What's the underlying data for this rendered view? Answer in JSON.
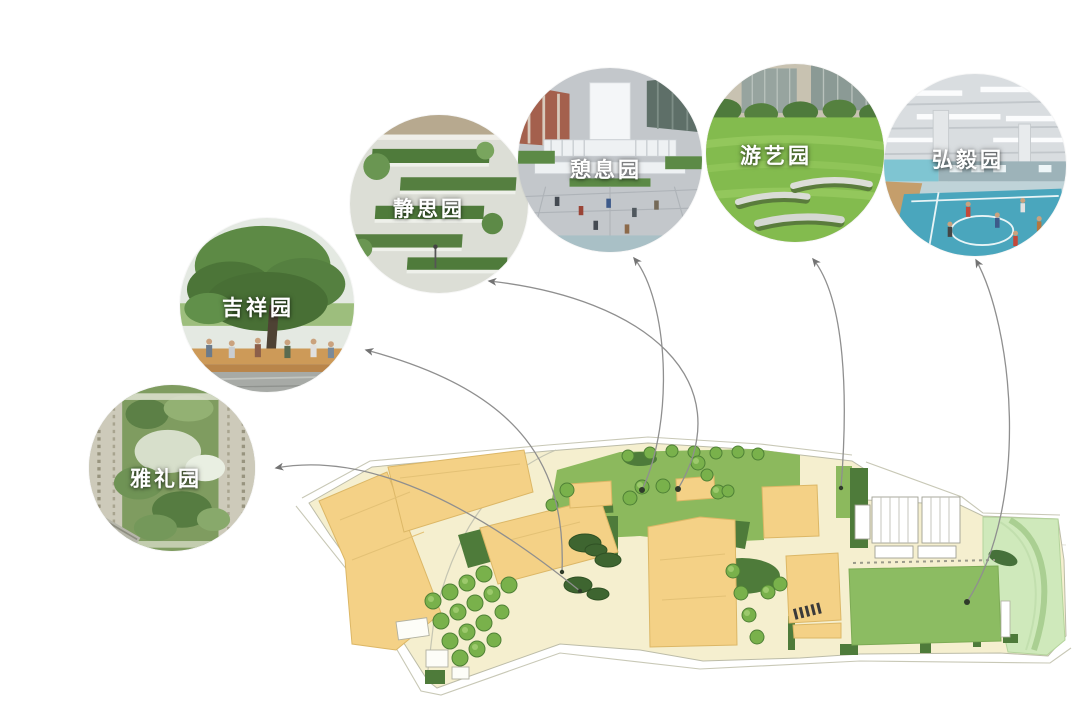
{
  "figure": {
    "type": "campus-landscape-diagram",
    "description_note": "site plan with six circular photo callouts connected by curved arrows"
  },
  "gardens": [
    {
      "id": "yali",
      "label": "雅礼园"
    },
    {
      "id": "jixiang",
      "label": "吉祥园"
    },
    {
      "id": "jingsi",
      "label": "静思园"
    },
    {
      "id": "qixi",
      "label": "憩息园"
    },
    {
      "id": "youyi",
      "label": "游艺园"
    },
    {
      "id": "hongyi",
      "label": "弘毅园"
    }
  ],
  "colors": {
    "background": "#ffffff",
    "site_cream": "#f5efcf",
    "building_yellow": "#f4d186",
    "building_edge": "#dcb766",
    "roof_lawn_green": "#8cb95d",
    "field_green": "#8cbc62",
    "dark_planting_green": "#4e7b3a",
    "tree_green": "#79b14b",
    "light_green_right": "#cfe9bb",
    "connector_gray": "#8f8f8f",
    "label_white": "#ffffff"
  }
}
